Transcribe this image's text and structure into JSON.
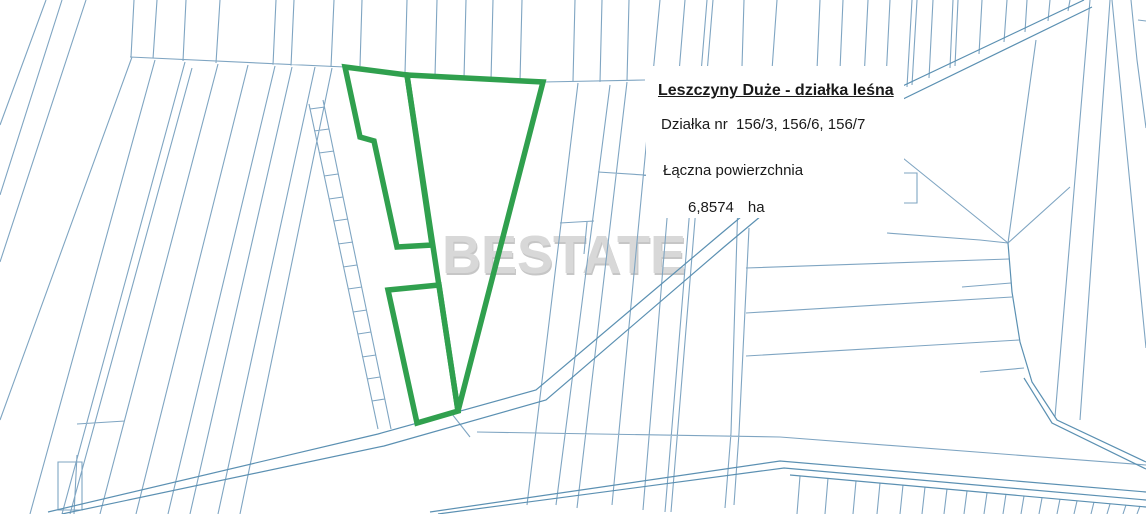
{
  "map": {
    "watermark": "BESTATE",
    "info_panel": {
      "title": "Leszczyny Duże - działka leśna",
      "parcels_line": "Działka nr  156/3, 156/6, 156/7",
      "area_label": "Łączna powierzchnia",
      "area_value": "6,8574",
      "area_unit": "ha"
    },
    "colors": {
      "highlighted_parcel": "#30a04e",
      "cadastral_line": "#7fa5c2",
      "road_line": "#5b90b2",
      "watermark_gray": "#d8d8d8"
    }
  }
}
